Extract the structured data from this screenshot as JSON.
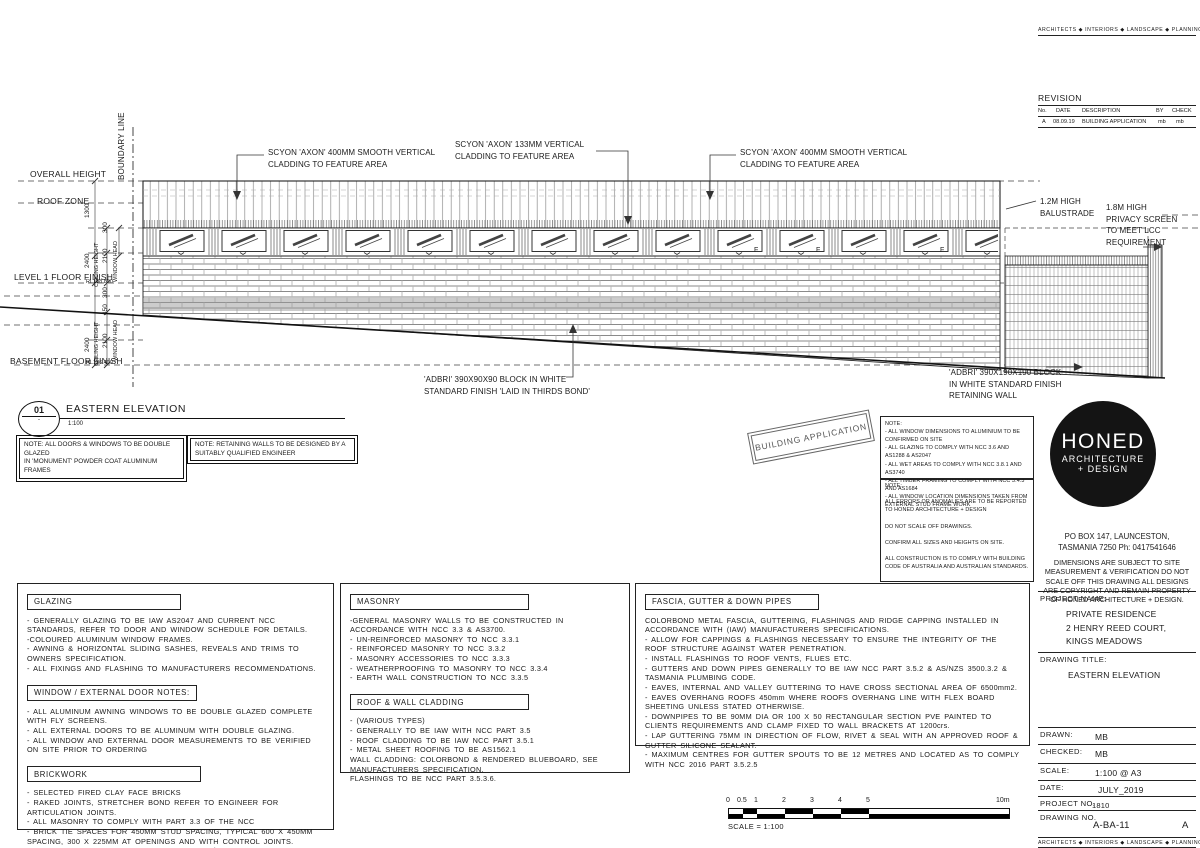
{
  "brand": {
    "line": "ARCHITECTS ◆ INTERIORS ◆ LANDSCAPE ◆ PLANNING"
  },
  "revision": {
    "title": "REVISION",
    "col_no": "No.",
    "col_date": "DATE",
    "col_desc": "DESCRIPTION",
    "col_by": "BY",
    "col_check": "CHECK",
    "row": {
      "no": "A",
      "date": "08.09.19",
      "desc": "BUILDING APPLICATION",
      "by": "mb",
      "check": "mb"
    }
  },
  "drawing": {
    "boundary": "BOUNDARY LINE",
    "overall_height": "OVERALL HEIGHT",
    "roof_zone": "ROOF ZONE",
    "level1": "LEVEL 1 FLOOR FINISH",
    "basement": "BASEMENT FLOOR FINISH",
    "rl_level1": "RL138.850",
    "rl_basement": "RL136.400",
    "dim_roof": "1300",
    "dim_300": "300",
    "dim_ceiling": "2400",
    "ceiling_label": "CEILING HEIGHT",
    "dim_window": "2100",
    "window_head_label": "WINDOW HEAD",
    "dim_450": "450",
    "window_label": "F",
    "callout_left": "SCYON 'AXON' 400MM SMOOTH VERTICAL\nCLADDING TO FEATURE AREA",
    "callout_mid": "SCYON 'AXON' 133MM VERTICAL\nCLADDING TO FEATURE AREA",
    "callout_right": "SCYON 'AXON' 400MM SMOOTH VERTICAL\nCLADDING TO FEATURE AREA",
    "balustrade": "1.2M HIGH\nBALUSTRADE",
    "privacy": "1.8M HIGH\nPRIVACY SCREEN\nTO MEET LCC\nREQUIREMENT",
    "adbri_left": "'ADBRI' 390X90X90 BLOCK IN WHITE\nSTANDARD FINISH 'LAID IN THIRDS BOND'",
    "adbri_right": "'ADBRI' 390X190X190 BLOCK\nIN WHITE STANDARD FINISH\nRETAINING WALL"
  },
  "title_mark": {
    "number": "01",
    "dot": "-",
    "title": "EASTERN ELEVATION",
    "scale": "1:100"
  },
  "notes_inline": {
    "box1": "NOTE: ALL DOORS & WINDOWS TO BE DOUBLE GLAZED\nIN 'MONUMENT' POWDER COAT ALUMINUM FRAMES",
    "box2": "NOTE: RETAINING WALLS TO BE DESIGNED BY A\nSUITABLY QUALIFIED ENGINEER"
  },
  "stamp": "BUILDING APPLICATION",
  "notes_panel": {
    "title1": "NOTE:",
    "body1": "- ALL WINDOW DIMENSIONS TO ALUMINIUM TO BE CONFIRMED ON SITE\n- ALL GLAZING TO COMPLY WITH NCC 3.6 AND AS1288 & AS2047\n- ALL WET AREAS TO COMPLY WITH NCC 3.8.1 AND AS3740\n- ALL TIMBER FRAMING TO COMPLY WITH NCC 3.4.3 AND AS1684\n- ALL WINDOW LOCATION DIMENSIONS TAKEN FROM EXTERNAL STUD FRAME WORK",
    "title2": "NOTE:",
    "body2": "ALL ERRORS OR ANOMALIES ARE TO BE REPORTED TO HONED ARCHITECTURE + DESIGN\n\nDO NOT SCALE OFF DRAWINGS.\n\nCONFIRM ALL SIZES AND HEIGHTS ON SITE.\n\nALL CONSTRUCTION IS TO COMPLY WITH BUILDING CODE OF AUSTRALIA AND AUSTRALIAN STANDARDS."
  },
  "logo": {
    "name": "HONED",
    "line2": "ARCHITECTURE",
    "line3": "+ DESIGN"
  },
  "firm": {
    "address": "PO BOX 147, LAUNCESTON,\nTASMANIA 7250    Ph: 0417541646",
    "disclaimer": "DIMENSIONS ARE SUBJECT TO SITE MEASUREMENT & VERIFICATION DO NOT SCALE OFF THIS DRAWING ALL DESIGNS ARE COPYRIGHT AND REMAIN PROPERTY OF HONED ARCHITECTURE + DESIGN."
  },
  "title_block": {
    "project_name_label": "PROJECT NAME:",
    "project_name": "PRIVATE RESIDENCE\n2 HENRY REED COURT,\nKINGS MEADOWS",
    "drawing_title_label": "DRAWING TITLE:",
    "drawing_title": "EASTERN ELEVATION",
    "drawn_label": "DRAWN:",
    "drawn": "MB",
    "checked_label": "CHECKED:",
    "checked": "MB",
    "scale_label": "SCALE:",
    "scale": "1:100 @ A3",
    "date_label": "DATE:",
    "date": "JULY_2019",
    "project_no_label": "PROJECT NO.",
    "project_no": "1810",
    "drawing_no_label": "DRAWING NO.",
    "drawing_no": "A-BA-11",
    "rev": "A"
  },
  "specs": {
    "glazing_title": "GLAZING",
    "glazing_body": "- GENERALLY GLAZING TO BE IAW AS2047 AND CURRENT NCC STANDARDS, REFER TO DOOR AND WINDOW SCHEDULE FOR DETAILS.\n-COLOURED ALUMINUM WINDOW FRAMES.\n- AWNING & HORIZONTAL SLIDING SASHES, REVEALS AND TRIMS TO OWNERS SPECIFICATION.\n- ALL FIXINGS AND FLASHING TO MANUFACTURERS RECOMMENDATIONS.",
    "window_title": "WINDOW / EXTERNAL DOOR NOTES:",
    "window_body": "- ALL ALUMINUM AWNING WINDOWS TO BE DOUBLE GLAZED COMPLETE WITH FLY SCREENS.\n- ALL EXTERNAL DOORS TO BE ALUMINUM WITH DOUBLE GLAZING.\n- ALL WINDOW AND EXTERNAL DOOR MEASUREMENTS TO BE VERIFIED ON SITE PRIOR TO ORDERING",
    "brickwork_title": "BRICKWORK",
    "brickwork_body": "- SELECTED FIRED CLAY FACE BRICKS\n- RAKED JOINTS, STRETCHER BOND REFER TO ENGINEER FOR ARTICULATION JOINTS.\n- ALL MASONRY TO COMPLY WITH PART 3.3 OF THE NCC\n- BRICK TIE SPACES FOR 450MM STUD SPACING, TYPICAL 600 X 450MM SPACING, 300 X 225MM AT OPENINGS AND WITH CONTROL JOINTS.\nFOR DETAILS REFER TO NCC 2016 PART 3.3.3 / AS 3700 & AS 4773.",
    "masonry_title": "MASONRY",
    "masonry_body": "-GENERAL MASONRY WALLS TO BE CONSTRUCTED IN ACCORDANCE WITH NCC 3.3 & AS3700.\n- UN-REINFORCED MASONRY TO NCC 3.3.1\n- REINFORCED MASONRY TO NCC 3.3.2\n- MASONRY ACCESSORIES TO NCC 3.3.3\n- WEATHERPROOFING TO MASONRY TO NCC 3.3.4\n- EARTH WALL CONSTRUCTION TO NCC 3.3.5",
    "roof_title": "ROOF & WALL CLADDING",
    "roof_body": "- (VARIOUS TYPES)\n- GENERALLY TO BE IAW WITH NCC PART 3.5\n- ROOF CLADDING TO BE IAW NCC PART 3.5.1\n- METAL SHEET ROOFING TO BE AS1562.1\nWALL CLADDING: COLORBOND & RENDERED BLUEBOARD, SEE MANUFACTURERS SPECIFICATION.\nFLASHINGS TO BE NCC PART 3.5.3.6.",
    "fascia_title": "FASCIA, GUTTER & DOWN PIPES",
    "fascia_body": "COLORBOND METAL FASCIA, GUTTERING, FLASHINGS AND RIDGE CAPPING INSTALLED IN ACCORDANCE WITH (IAW) MANUFACTURERS SPECIFICATIONS.\n- ALLOW FOR CAPPINGS & FLASHINGS NECESSARY TO ENSURE THE INTEGRITY OF THE ROOF STRUCTURE AGAINST WATER PENETRATION.\n- INSTALL FLASHINGS TO ROOF VENTS, FLUES ETC.\n- GUTTERS AND DOWN PIPES GENERALLY TO BE IAW NCC PART 3.5.2 & AS/NZS 3500.3.2 & TASMANIA PLUMBING CODE.\n- EAVES, INTERNAL AND VALLEY GUTTERING TO HAVE CROSS SECTIONAL AREA OF 6500mm2.\n- EAVES OVERHANG ROOFS 450mm WHERE ROOFS OVERHANG LINE WITH FLEX BOARD SHEETING UNLESS STATED OTHERWISE.\n- DOWNPIPES TO BE 90MM DIA OR 100 X 50 RECTANGULAR SECTION PVE PAINTED TO CLIENTS REQUIREMENTS AND CLAMP FIXED TO WALL BRACKETS AT 1200crs.\n- LAP GUTTERING 75MM IN DIRECTION OF FLOW, RIVET & SEAL WITH AN APPROVED ROOF & GUTTER SILICONE SEALANT.\n- MAXIMUM CENTRES FOR GUTTER SPOUTS TO BE 12 METRES AND LOCATED AS TO COMPLY WITH NCC 2016 PART 3.5.2.5"
  },
  "scale_bar": {
    "t0": "0",
    "t05": "0.5",
    "t1": "1",
    "t2": "2",
    "t3": "3",
    "t4": "4",
    "t5": "5",
    "t10": "10m",
    "label": "SCALE = 1:100"
  }
}
